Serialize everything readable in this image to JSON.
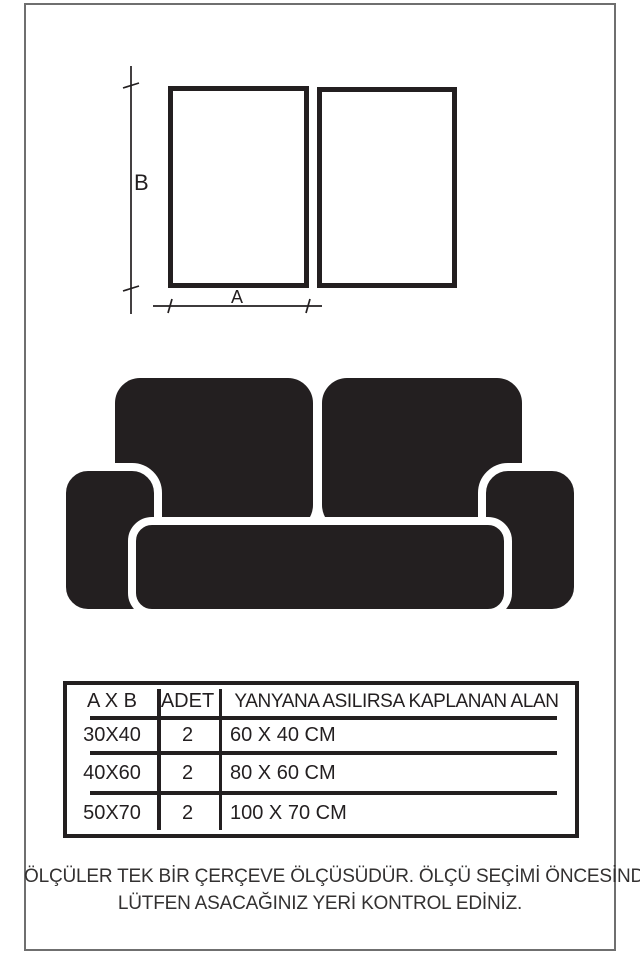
{
  "colors": {
    "ink": "#231f20",
    "image_border": "#6f6f6f",
    "background": "#ffffff"
  },
  "dimension_diagram": {
    "height_label": "B",
    "width_label": "A",
    "frames_count": 2
  },
  "size_table": {
    "headers": [
      "A X B",
      "ADET",
      "YANYANA ASILIRSA KAPLANAN ALAN"
    ],
    "rows": [
      {
        "size": "30X40",
        "qty": "2",
        "area": "60 X 40 CM"
      },
      {
        "size": "40X60",
        "qty": "2",
        "area": "80 X 60 CM"
      },
      {
        "size": "50X70",
        "qty": "2",
        "area": "100 X 70 CM"
      }
    ]
  },
  "footer": {
    "line1": "ÖLÇÜLER TEK BİR ÇERÇEVE ÖLÇÜSÜDÜR. ÖLÇÜ SEÇİMİ ÖNCESİNDE",
    "line2": "LÜTFEN ASACAĞINIZ YERİ KONTROL EDİNİZ."
  }
}
